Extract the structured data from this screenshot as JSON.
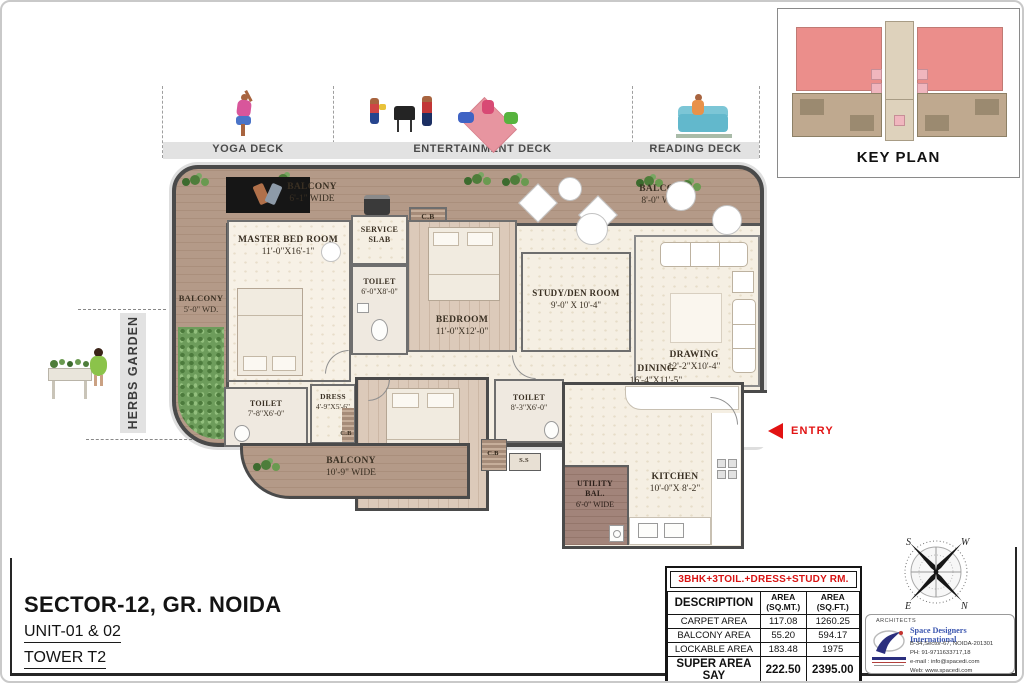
{
  "colors": {
    "accent_red": "#e21212",
    "table_title_red": "#d81414",
    "balcony_wood": "#b49a88",
    "floor_cream": "#f5efe3",
    "keyplan_highlight_red": "#eb8e8b",
    "architect_blue": "#3b56b0",
    "wall_gray": "#4a4a4a"
  },
  "icons": {
    "entry_arrow_icon": "left-red-triangle",
    "plant_icon": "green-shrub-cluster",
    "compass_rose_icon": "four-point-compass"
  },
  "decks": {
    "sections": [
      {
        "label": "YOGA DECK"
      },
      {
        "label": "ENTERTAINMENT DECK"
      },
      {
        "label": "READING DECK"
      }
    ]
  },
  "key_plan": {
    "title": "KEY PLAN"
  },
  "plan": {
    "entry_label": "ENTRY",
    "herbs_garden_label": "HERBS GARDEN",
    "rooms": {
      "balcony_top_left": {
        "name": "BALCONY",
        "dim": "6'-1\" WIDE"
      },
      "balcony_top_right": {
        "name": "BALCONY",
        "dim": "8'-0\" WIDE"
      },
      "balcony_left": {
        "name": "BALCONY",
        "dim": "5'-0\" WD."
      },
      "master_bedroom": {
        "name": "MASTER BED ROOM",
        "dim": "11'-0\"X16'-1\""
      },
      "service_slab": {
        "name": "SERVICE SLAB"
      },
      "toilet_master": {
        "name": "TOILET",
        "dim": "6'-0\"X8'-0\""
      },
      "cupboard1": {
        "name": "C.B"
      },
      "bedroom2": {
        "name": "BEDROOM",
        "dim": "11'-0\"X12'-0\""
      },
      "study": {
        "name": "STUDY/DEN ROOM",
        "dim": "9'-0\" X 10'-4\""
      },
      "drawing": {
        "name": "DRAWING",
        "dim": "12'-2\"X10'-4\""
      },
      "dining": {
        "name": "DINING",
        "dim": "16'-4\"X11'-5\""
      },
      "kitchen": {
        "name": "KITCHEN",
        "dim": "10'-0\"X 8'-2\""
      },
      "utility_balcony": {
        "name": "UTILITY BAL.",
        "dim": "6'-0\" WIDE"
      },
      "toilet2": {
        "name": "TOILET",
        "dim": "7'-8\"X6'-0\""
      },
      "dress": {
        "name": "DRESS",
        "dim": "4'-9\"X5'-6\"",
        "cupboard": "C.B"
      },
      "balcony_bottom": {
        "name": "BALCONY",
        "dim": "10'-9\" WIDE"
      },
      "bedroom3": {
        "name": "BEDROOM",
        "dim": "12'-0\"X11'-3\""
      },
      "toilet3": {
        "name": "TOILET",
        "dim": "8'-3\"X6'-0\""
      },
      "cupboard2": {
        "name": "C.B"
      },
      "service_shaft": {
        "name": "S.S"
      }
    }
  },
  "title_block": {
    "location": "SECTOR-12, GR. NOIDA",
    "unit": "UNIT-01 & 02",
    "tower": "TOWER T2"
  },
  "area_table": {
    "title": "3BHK+3TOIL.+DRESS+STUDY RM.",
    "col_headers": {
      "description": "DESCRIPTION",
      "sqmt": "AREA\n(SQ.MT.)",
      "sqft": "AREA\n(SQ.FT.)"
    },
    "rows": [
      {
        "label": "CARPET AREA",
        "sqmt": "117.08",
        "sqft": "1260.25"
      },
      {
        "label": "BALCONY AREA",
        "sqmt": "55.20",
        "sqft": "594.17"
      },
      {
        "label": "LOCKABLE AREA",
        "sqmt": "183.48",
        "sqft": "1975"
      },
      {
        "label": "SUPER AREA SAY",
        "sqmt": "222.50",
        "sqft": "2395.00"
      }
    ]
  },
  "architect": {
    "heading": "ARCHITECTS",
    "name": "Space Designers International",
    "address": "B-34,Sector-67, NOIDA-201301",
    "phone": "PH: 91-9711633717,18",
    "email": "e-mail : info@spacedi.com",
    "website": "Web: www.spacedi.com"
  },
  "compass": {
    "top_left": "S",
    "top_right": "W",
    "bottom_left": "E",
    "bottom_right": "N"
  }
}
